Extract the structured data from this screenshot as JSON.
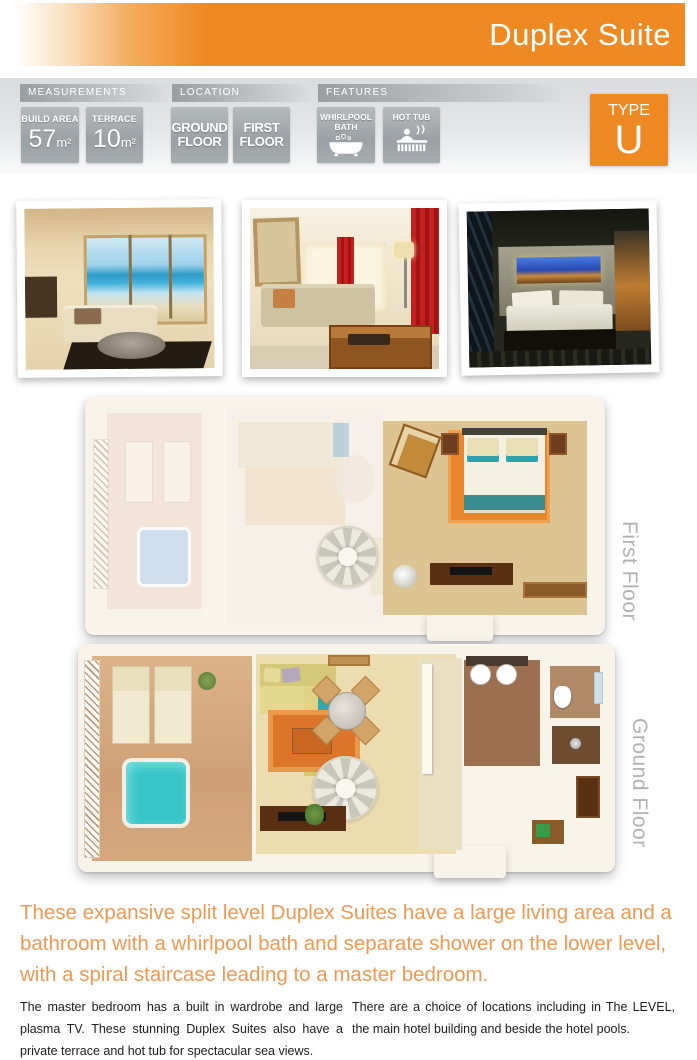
{
  "header": {
    "title": "Duplex Suite"
  },
  "measurements": {
    "label": "MEASUREMENTS",
    "badges": [
      {
        "label": "BUILD AREA",
        "value": "57",
        "unit": "m²"
      },
      {
        "label": "TERRACE",
        "value": "10",
        "unit": "m²"
      }
    ]
  },
  "location": {
    "label": "LOCATION",
    "badges": [
      {
        "line1": "GROUND",
        "line2": "FLOOR"
      },
      {
        "line1": "FIRST",
        "line2": "FLOOR"
      }
    ]
  },
  "features": {
    "label": "FEATURES",
    "badges": [
      {
        "line1": "WHIRLPOOL",
        "line2": "BATH",
        "icon": "bathtub-icon"
      },
      {
        "line1": "HOT TUB",
        "icon": "hot-tub-icon"
      }
    ]
  },
  "type_badge": {
    "label": "TYPE",
    "value": "U"
  },
  "floor_plans": [
    {
      "label": "First Floor"
    },
    {
      "label": "Ground Floor"
    }
  ],
  "intro": {
    "text": "These expansive split level Duplex Suites have a large living area and a bathroom with a whirlpool bath and separate shower on the lower level, with a spiral staircase leading to a master bedroom."
  },
  "columns": {
    "left": "The master bedroom has a built in wardrobe and large plasma TV. These stunning Duplex Suites also have a private terrace and hot tub for spectacular sea views.",
    "right": "There are a choice of locations including in The LEVEL, the main hotel building and beside the hotel pools."
  },
  "colors": {
    "accent_orange": "#ef8a23",
    "intro_orange": "#f0994e",
    "badge_gray": "#a3a8ab",
    "floor_label_gray": "#b2b2b4"
  }
}
